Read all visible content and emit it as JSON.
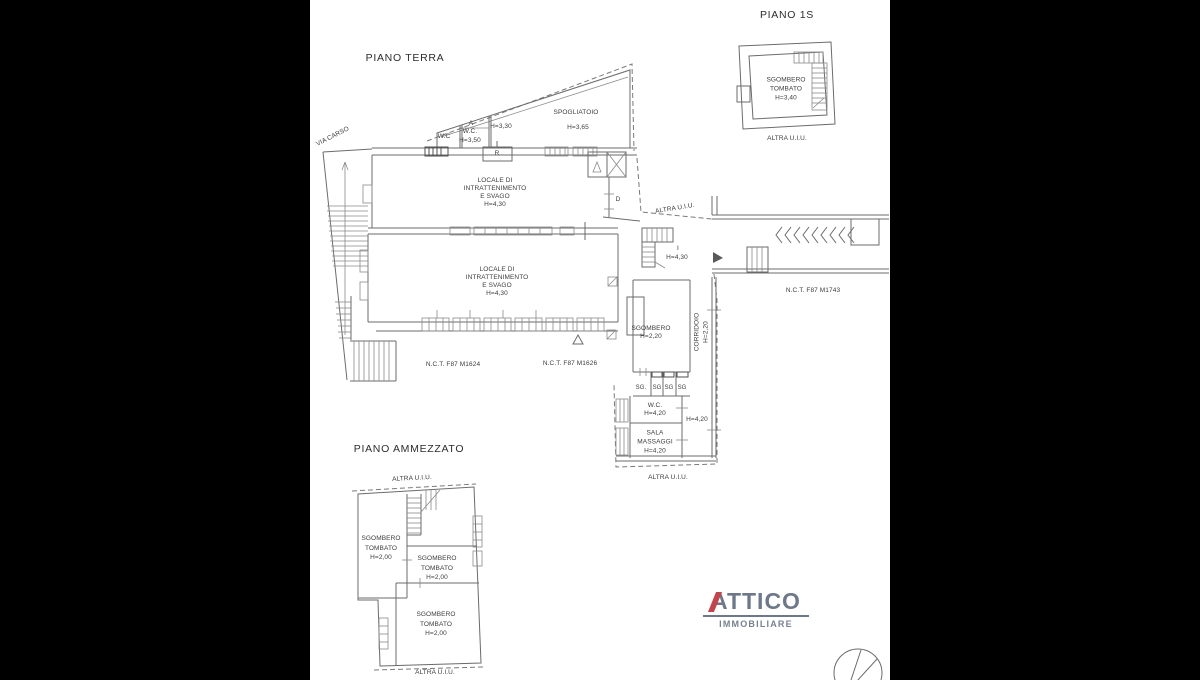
{
  "canvas": {
    "background": "#000000",
    "paper": "#ffffff",
    "line_color": "#6b6b6b",
    "text_color": "#3c3c3c"
  },
  "piano_1s": {
    "title": "PIANO 1S",
    "room": {
      "line1": "SGOMBERO",
      "line2": "TOMBATO",
      "line3": "H=3,40"
    },
    "footer": "ALTRA U.I.U."
  },
  "piano_terra": {
    "title": "PIANO TERRA",
    "street_label": "VIA CARSO",
    "wc_left": "W.C",
    "anti_label": "A",
    "wc_right": "W.C.",
    "wc_right_h": "H=3,50",
    "h_330": "H=3,30",
    "spogliatoio": "SPOGLIATOIO",
    "spogliatoio_h": "H=3,65",
    "r_label": "R",
    "hall_upper": {
      "line1": "LOCALE DI",
      "line2": "INTRATTENIMENTO",
      "line3": "E SVAGO",
      "line4": "H=4,30"
    },
    "hall_lower": {
      "line1": "LOCALE DI",
      "line2": "INTRATTENIMENTO",
      "line3": "E SVAGO",
      "line4": "H=4,30"
    },
    "d_label": "D",
    "altra_mid": "ALTRA U.I.U.",
    "i_label": "I",
    "i_h": "H=4,30",
    "nct_1743": "N.C.T. F87 M1743",
    "nct_1624": "N.C.T. F87 M1624",
    "nct_1626": "N.C.T. F87 M1626",
    "sgombero": {
      "line1": "SGOMBERO",
      "line2": "H=2,20"
    },
    "corridoio": {
      "line1": "CORRIDOIO",
      "line2": "H=2,20"
    },
    "sg_cells": [
      "SG.",
      "SG",
      "SG",
      "SG"
    ],
    "wc_low": {
      "line1": "W.C.",
      "line2": "H=4,20"
    },
    "corridoio_h": "H=4,20",
    "sala": {
      "line1": "SALA",
      "line2": "MASSAGGI",
      "line3": "H=4,20"
    },
    "altra_bottom": "ALTRA U.I.U."
  },
  "piano_ammezzato": {
    "title": "PIANO AMMEZZATO",
    "altra_top": "ALTRA U.I.U.",
    "room_left": {
      "line1": "SGOMBERO",
      "line2": "TOMBATO",
      "line3": "H=2,00"
    },
    "room_mid": {
      "line1": "SGOMBERO",
      "line2": "TOMBATO",
      "line3": "H=2,00"
    },
    "room_bottom": {
      "line1": "SGOMBERO",
      "line2": "TOMBATO",
      "line3": "H=2,00"
    },
    "altra_bottom": "ALTRA U.I.U."
  },
  "logo": {
    "name": "ATTICO",
    "subtitle": "IMMOBILIARE",
    "text_color": "#6d7888",
    "accent_color": "#c2454e"
  }
}
